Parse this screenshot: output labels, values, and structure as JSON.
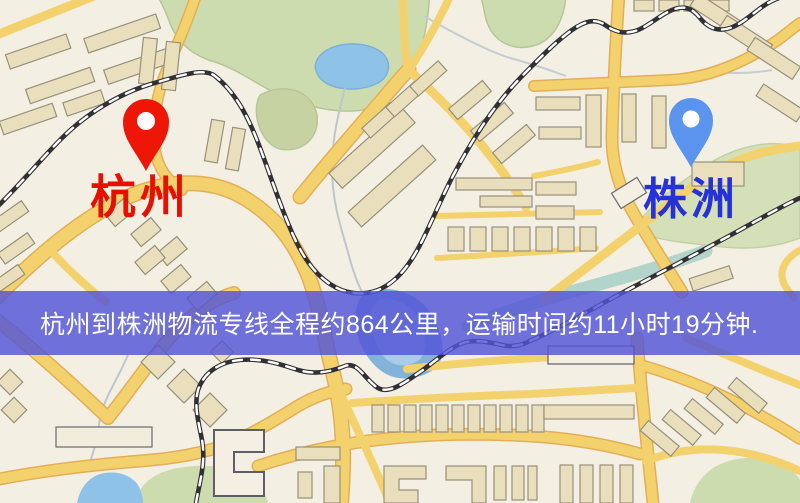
{
  "map": {
    "origin": {
      "label": "杭州",
      "label_color": "#e60f00",
      "pin_color": "#ee1606"
    },
    "destination": {
      "label": "株洲",
      "label_color": "#2631d8",
      "pin_color": "#5b94ef"
    },
    "banner": {
      "text": "杭州到株洲物流专线全程约864公里，运输时间约11小时19分钟.",
      "background_rgba": "rgba(82,84,215,0.82)",
      "text_color": "#ffffff",
      "distance_km": "864",
      "duration": "11小时19分钟"
    },
    "palette": {
      "land": "#f3efe3",
      "road_fill": "#f3d26e",
      "road_casing": "#e3ae57",
      "building": "#eadfbd",
      "building_outline": "#97907b",
      "green_area": "#cddcae",
      "water": "#8ec2e6",
      "railway": "#303035"
    }
  }
}
